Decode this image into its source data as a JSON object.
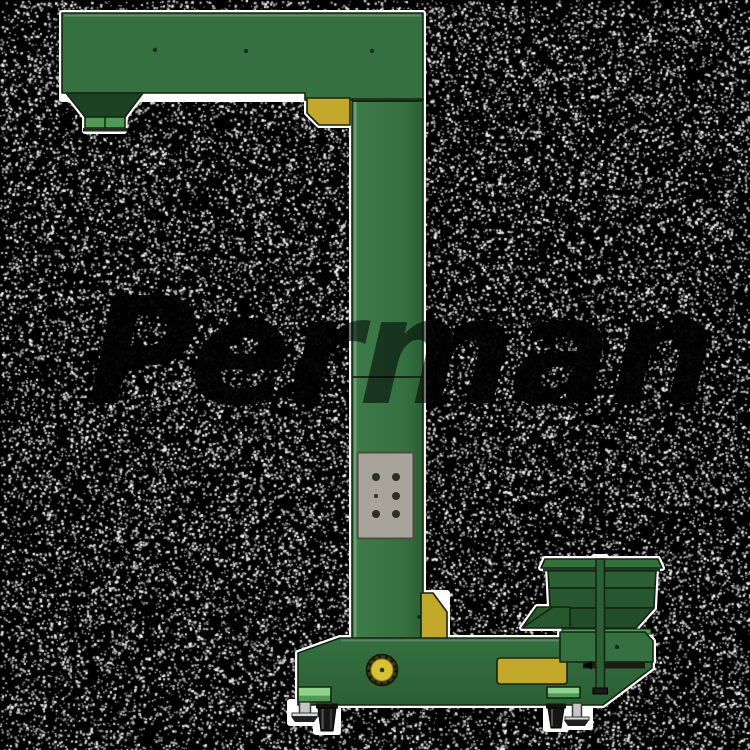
{
  "image": {
    "width": 750,
    "height": 750,
    "description_name": "bucket-elevator-product-render"
  },
  "watermark": {
    "text": "Perman"
  },
  "background": {
    "base_color": "#000000",
    "dot_color": "#ffffff",
    "dot_density": 0.17,
    "seed": 42
  },
  "machine": {
    "colors": {
      "main": "#357040",
      "mainLight": "#3f7c4a",
      "mainDark": "#2b5f34",
      "band": "#27562f",
      "deep": "#1c4024",
      "stripLight": "#8fd18d",
      "stripMid": "#4f9b56",
      "yellow": "#c3a92b",
      "yellowBright": "#d6c235",
      "panelGray": "#a8a49c",
      "outline": "#152410",
      "metal": "#c6c6c6",
      "wheel": "#161613",
      "halo": "#ffffff"
    }
  }
}
